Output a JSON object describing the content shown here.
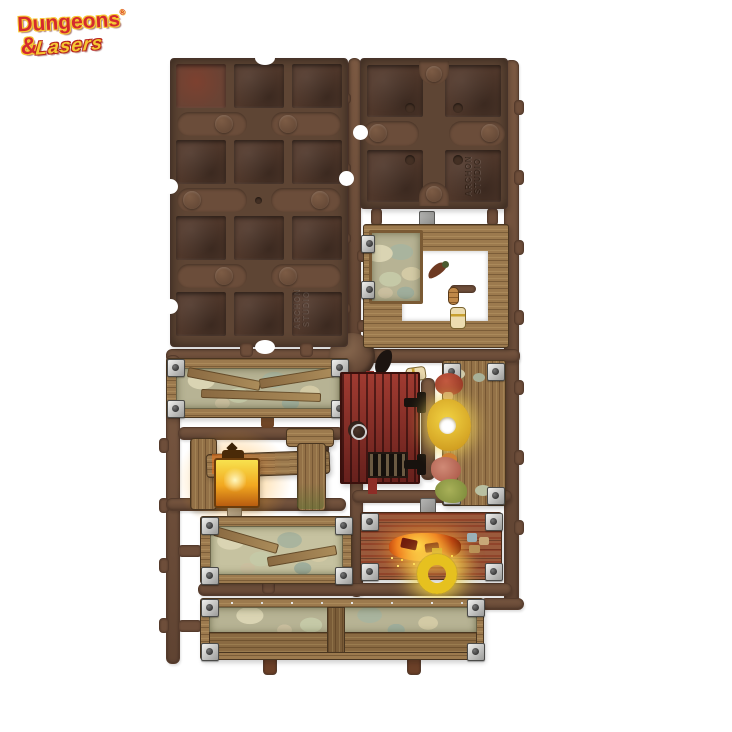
{
  "logo": {
    "dungeons": "Dungeons",
    "registered": "®",
    "ampersand": "&",
    "lasers": "Lasers"
  },
  "sprue": {
    "embossed_line1": "ARCHON",
    "embossed_line2": "STUDIO",
    "parts": [
      {
        "id": "floor-tile-panel-large",
        "label": "floor tile panel back, 3 x 4 sockets"
      },
      {
        "id": "floor-tile-panel-small",
        "label": "floor tile panel back, 2 x 2 sockets, Archon Studio embossing"
      },
      {
        "id": "doorway-frame",
        "label": "timber doorway frame with stone corner"
      },
      {
        "id": "hanging-provisions",
        "label": "powder horn, sausage and flask"
      },
      {
        "id": "stone-timber-wall-top-left",
        "label": "stone and timber wall panel with metal corner brackets"
      },
      {
        "id": "red-door",
        "label": "red plank door with iron ring and black hinges"
      },
      {
        "id": "mushroom-timber-wall",
        "label": "timber wall with glowing yellow and red mushrooms"
      },
      {
        "id": "lantern-beam",
        "label": "timber beam and posts with glowing lantern"
      },
      {
        "id": "stone-timber-wall-bottom-left",
        "label": "stone and timber wall panel"
      },
      {
        "id": "forge-timber-wall",
        "label": "timber wall with forge embers and glowing yellow ring"
      },
      {
        "id": "long-stone-timber-wall",
        "label": "long stone and timber wall panel with center post"
      }
    ],
    "colors": {
      "background": "#ffffff",
      "sprue_plastic": "#6b4c39",
      "tile_back": "#5d4434",
      "painted_wood": "#9c7a4e",
      "stone": "#c3bd9e",
      "metal_bracket": "#c9c9c7",
      "door_red": "#8e2d27",
      "lantern_glow": "#f5a623",
      "ring_glow": "#e8c31f",
      "mushroom_yellow": "#e6c532",
      "mushroom_red": "#b84a36",
      "logo_red": "#d42a2e",
      "logo_yellow": "#f6c832"
    }
  }
}
